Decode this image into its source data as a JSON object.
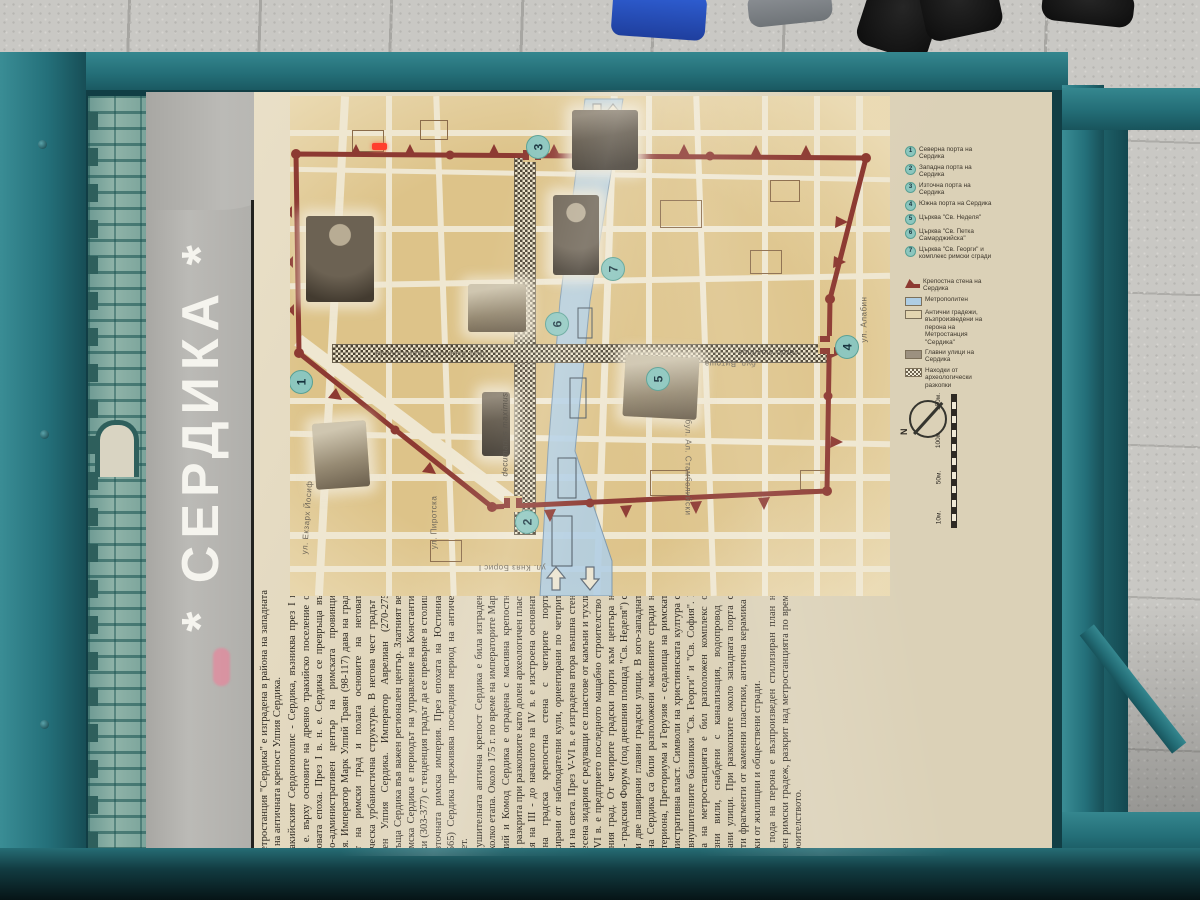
{
  "poster": {
    "title": "* СЕРДИКА *",
    "paragraphs": [
      "Метростанция \"Сердика\" е изградена в района на западната порта на античната крепост Улпия Сердика.",
      "Тракийският Сердонополис - Сердика, възниква през I в. пр. н. е. върху основите на древно тракийско поселение от бронзовата епоха. През I в. н. е. Сердика се превръща във военно-административен център на римската провинция Тракия. Император Марк Улпий Траян (98-117) дава на града статут на римски град и полага основите на неговата класическа урбанистична структура. В негова чест градът е наречен Улпия Сердика. Император Аврелиан (270-275) превръща Сердика във важен регионален център. Златният век на римска Сердика е периодът на управление на Константин Велики (303-377) с тенденция градът да се превърне в столица на Източната римска империя. През епохата на Юстиниан (527-565) Сердика преживява последния период на античен разцвет.",
      "Внушителната антична крепост Сердика е била изградена на няколко етапа. Около 175 г. по време на императорите Марк Аврелий и Комод Сердика е оградена с масивна крепостна стена, разкрита при разкопките като долен археологичен пласт. В края на III - до началото на IV в. е изстроена основната масивна градска крепостна стена с четирите порти, фланкирани от наблюдателни кули, ориентирани по четирите посоки на света. През V-VI в. е изградена втора външна стена от смесена зидария с редуващи се пластове от камъни и тухли. През VI в. е предприето последното мащабно строителство в античния град. От четирите градски порти към центъра на града - градския Форум (под днешния площад \"Св. Неделя\") са водели две павирани главни градски улици. В юго-западната част на Сердика са били разположени масивните сгради на Булевтериона, Преториума и Герузия - седалища на римската административна власт. Символи на християнската култура са били внушителните базилики \"Св. Георги\" и \"Св. София\". В района на метростанцията е бил разположен комплекс от луксозни вили, снабдени с канализация, водопровод и павирани улици. При разкопките около западната порта са открити фрагменти от каменни пластики, антична керамика и останки от жилищни и обществени сгради.",
      "На пода на перона е възпроизведен стилизиран план на античен римски градеж, разкрит над метростанцията по време на строителството."
    ]
  },
  "legend": {
    "numbered": [
      {
        "num": "1",
        "label": "Северна порта на Сердика"
      },
      {
        "num": "2",
        "label": "Западна порта на Сердика"
      },
      {
        "num": "3",
        "label": "Източна порта на Сердика"
      },
      {
        "num": "4",
        "label": "Южна порта на Сердика"
      },
      {
        "num": "5",
        "label": "Църква \"Св. Неделя\""
      },
      {
        "num": "6",
        "label": "Църква \"Св. Петка Самарджийска\""
      },
      {
        "num": "7",
        "label": "Църква \"Св. Георги\" и комплекс римски сгради"
      }
    ],
    "symbols": [
      {
        "label": "Крепостна стена на Сердика",
        "swatch": "#8d3a32"
      },
      {
        "label": "Метрополитен",
        "swatch": "#aecde4"
      },
      {
        "label": "Антични градежи, възпроизведени на перона на Метростанция \"Сердика\"",
        "swatch": "#e3d5b0"
      },
      {
        "label": "Главни улици на Сердика",
        "swatch": "#9c9180"
      },
      {
        "label": "Находки от археологически разкопки",
        "swatch": "#f2ecd9"
      }
    ]
  },
  "map": {
    "north_label": "N",
    "scale_labels": [
      "150м.",
      "100м.",
      "50м.",
      "10м."
    ],
    "gates": [
      "1",
      "2",
      "3",
      "4",
      "5",
      "6",
      "7"
    ],
    "streets": [
      {
        "label": "ул. Екзарх Йосиф"
      },
      {
        "label": "ул. Пиротска"
      },
      {
        "label": "бул. Княгиня Мария Луиза"
      },
      {
        "label": "ул. Княз Борис I"
      },
      {
        "label": "бул. Ал. Стамболийски"
      },
      {
        "label": "бул. Витоша"
      },
      {
        "label": "ул. Алабин"
      },
      {
        "label": "decumanus maximus"
      },
      {
        "label": "cardo maximus"
      }
    ]
  },
  "colors": {
    "frame_teal": "#2a7d85",
    "wall_maroon": "#8d3a32",
    "metro_blue": "#aecde4",
    "parchment": "#e7dcc1",
    "map_tan": "#ddc389",
    "gate_circle": "#8cc6be",
    "title_band_grey": "#b2b1ad"
  }
}
